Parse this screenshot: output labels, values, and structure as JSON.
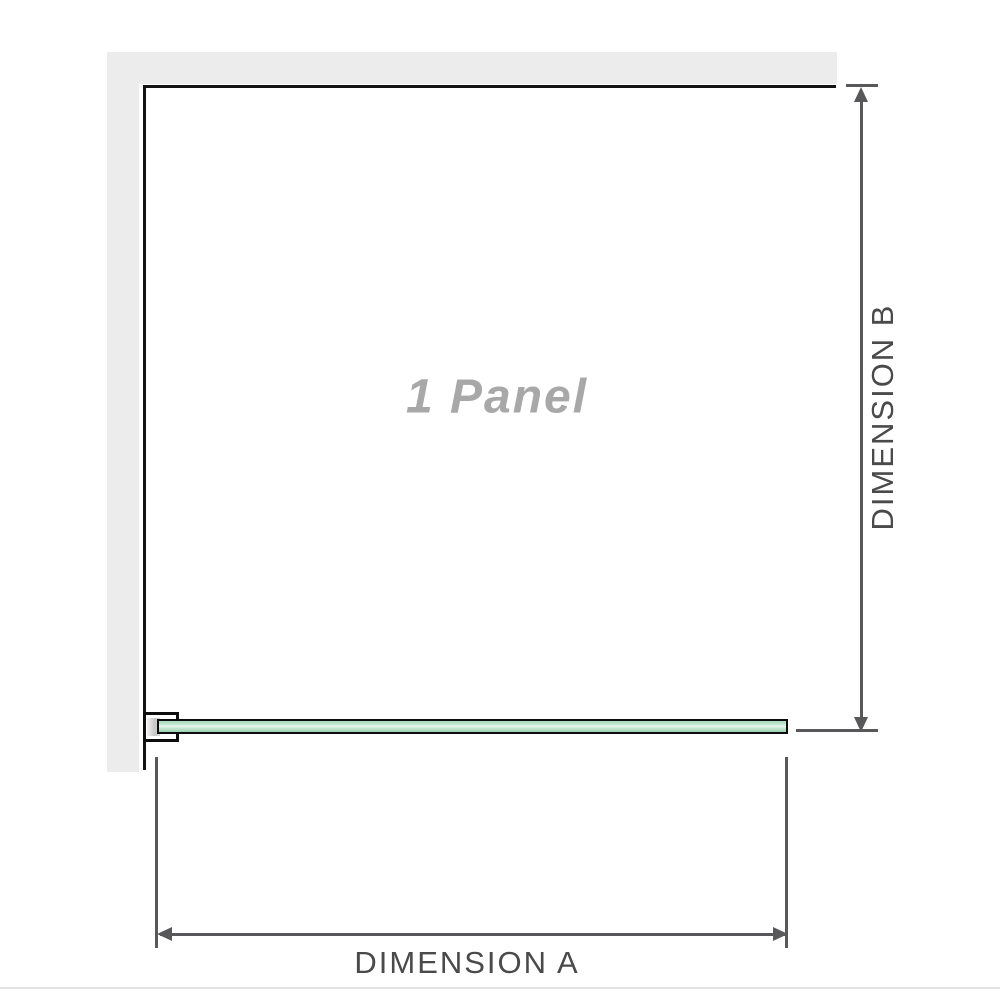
{
  "labels": {
    "panel": "1 Panel",
    "dimension_a": "DIMENSION A",
    "dimension_b": "DIMENSION B"
  },
  "colors": {
    "wall_fill": "#ececec",
    "outline": "#141414",
    "dimension_line": "#58585a",
    "dimension_text": "#4a4a4a",
    "panel_text": "#a8a8a8",
    "glass_fill": "#b5dfc5",
    "glass_highlight": "#ecf8f1",
    "bracket_metal": "#c6c6c6",
    "baseline_rule": "#e3e3e3"
  },
  "icons": {
    "dimension_b_arrows": "double-headed-vertical-arrow",
    "dimension_a_arrows": "double-headed-horizontal-arrow"
  }
}
